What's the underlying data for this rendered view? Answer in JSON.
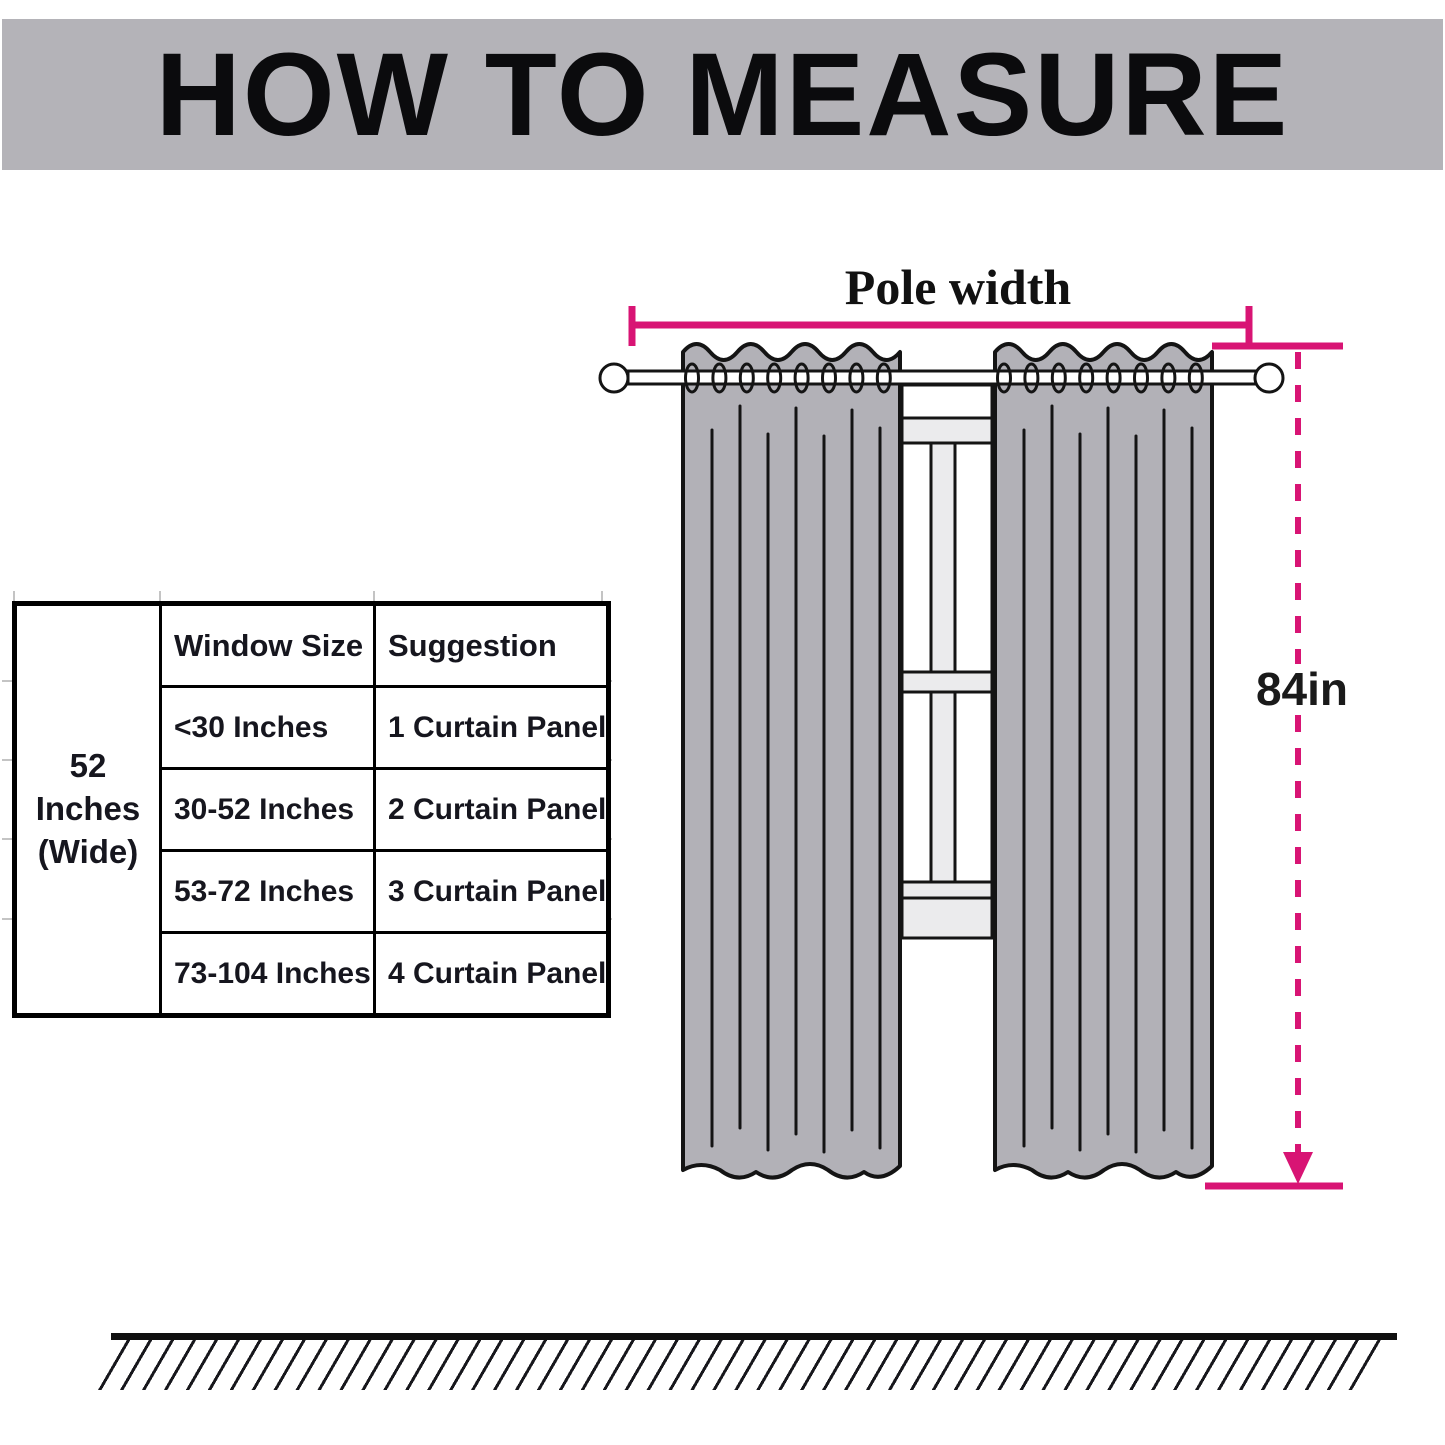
{
  "header": {
    "title": "HOW TO MEASURE"
  },
  "diagram": {
    "pole_width_label": "Pole width",
    "curtain_length_label": "84in"
  },
  "size_table": {
    "width_note": "52 Inches (Wide)",
    "columns": [
      "Window Size",
      "Suggestion"
    ],
    "rows": [
      {
        "window_size": "<30 Inches",
        "suggestion": "1 Curtain Panel"
      },
      {
        "window_size": "30-52 Inches",
        "suggestion": "2 Curtain Panel"
      },
      {
        "window_size": "53-72 Inches",
        "suggestion": "3 Curtain Panel"
      },
      {
        "window_size": "73-104 Inches",
        "suggestion": "4 Curtain Panel"
      }
    ]
  },
  "colors": {
    "accent_pink": "#D81474",
    "banner_gray": "#B4B3B8",
    "curtain_gray": "#B2B1B7",
    "window_trim_gray": "#EBEBED",
    "outline_ink": "#141414"
  }
}
